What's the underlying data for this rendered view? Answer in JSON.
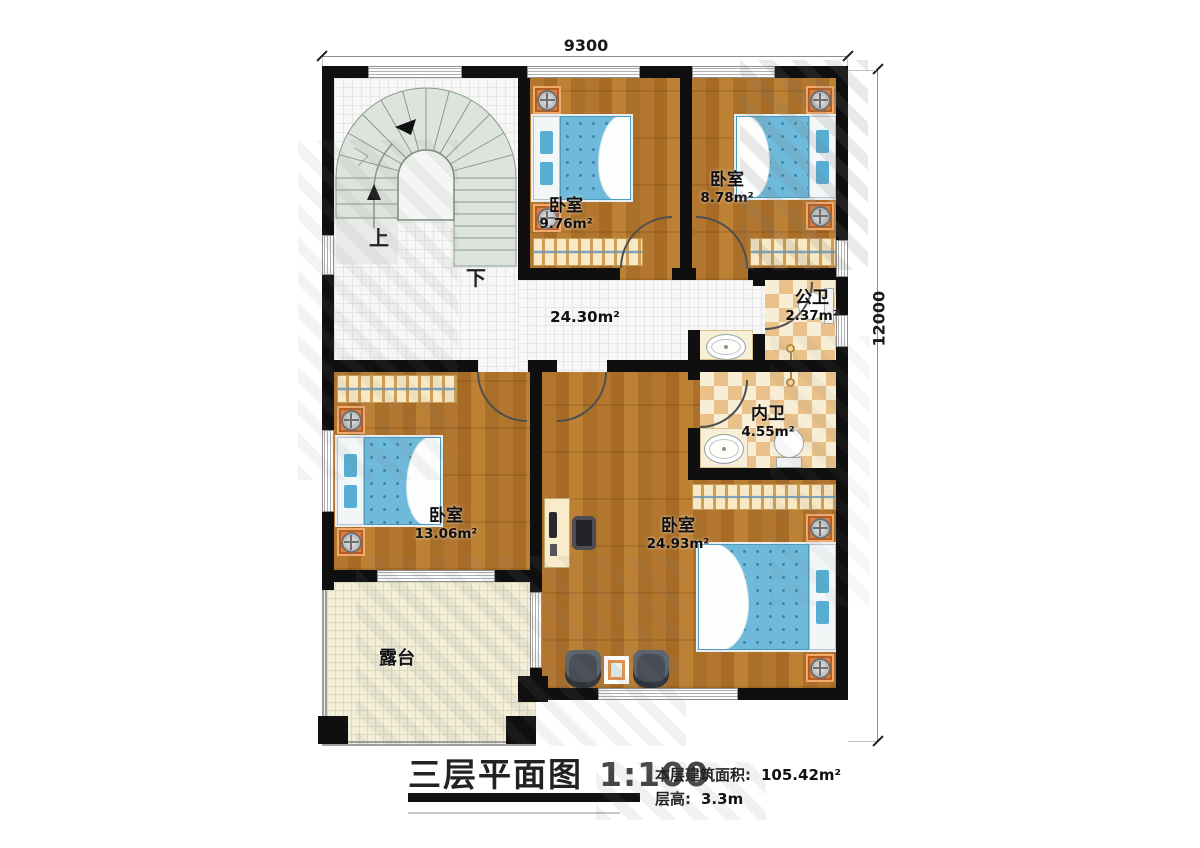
{
  "dims": {
    "top": "9300",
    "right": "12000"
  },
  "rooms": {
    "bedroom_a": {
      "name": "卧室",
      "area": "9.76m²"
    },
    "bedroom_b": {
      "name": "卧室",
      "area": "8.78m²"
    },
    "bedroom_c": {
      "name": "卧室",
      "area": "13.06m²"
    },
    "bedroom_master": {
      "name": "卧室",
      "area": "24.93m²"
    },
    "hall": {
      "area": "24.30m²"
    },
    "public_bath": {
      "name": "公卫",
      "area": "2.37m²"
    },
    "inner_bath": {
      "name": "内卫",
      "area": "4.55m²"
    },
    "terrace": {
      "name": "露台"
    }
  },
  "stairs": {
    "up": "上",
    "down": "下"
  },
  "titleblock": {
    "title": "三层平面图",
    "scale": "1:100",
    "area_label": "本层建筑面积:",
    "area_value": "105.42m²",
    "height_label": "层高:",
    "height_value": "3.3m"
  }
}
